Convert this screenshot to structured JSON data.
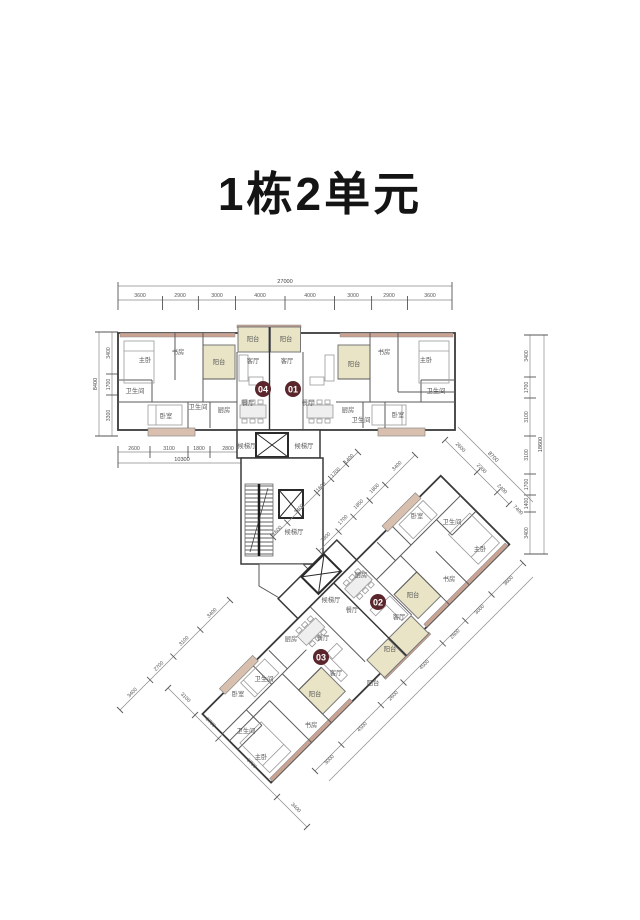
{
  "title": "1栋2单元",
  "units": {
    "u01": "01",
    "u02": "02",
    "u03": "03",
    "u04": "04"
  },
  "room_labels": {
    "master": "主卧",
    "study": "书房",
    "balcony": "阳台",
    "living": "客厅",
    "dining": "餐厅",
    "kitchen": "厨房",
    "bath": "卫生间",
    "bedroom": "卧室",
    "lobby": "候梯厅"
  },
  "dims": {
    "top_total": "27000",
    "top": [
      "3600",
      "2900",
      "3000",
      "4000",
      "4000",
      "3000",
      "2900",
      "3600"
    ],
    "left": [
      "3400",
      "1700",
      "3300"
    ],
    "left_total": "8400",
    "bottom_left": [
      "2600",
      "3100",
      "1800",
      "2800"
    ],
    "bottom_left_total": "10300",
    "right": [
      "3400",
      "1700",
      "3100",
      "3100",
      "1700",
      "1400",
      "3400"
    ],
    "right_total": "18600",
    "diag_7400": "7400",
    "diag_8700": "8700",
    "rot_core": [
      "3400",
      "1800",
      "1850",
      "1700",
      "2300"
    ],
    "rot_nw_upper": [
      "1400",
      "1700",
      "1600",
      "3400",
      "1600"
    ],
    "rot_nw_lower": [
      "3400",
      "3100",
      "2700",
      "3400"
    ],
    "rot_sw": [
      "3100",
      "2700",
      "6700",
      "3400"
    ],
    "rot_se": [
      "3600",
      "3000",
      "2600",
      "4500",
      "2600",
      "4500",
      "3000"
    ],
    "rot_ne": [
      "2600",
      "2300",
      "2400"
    ]
  },
  "colors": {
    "balcony_fill": "#e9e4c6",
    "wall_accent": "#c9a292",
    "unit_badge": "#5a262b"
  }
}
